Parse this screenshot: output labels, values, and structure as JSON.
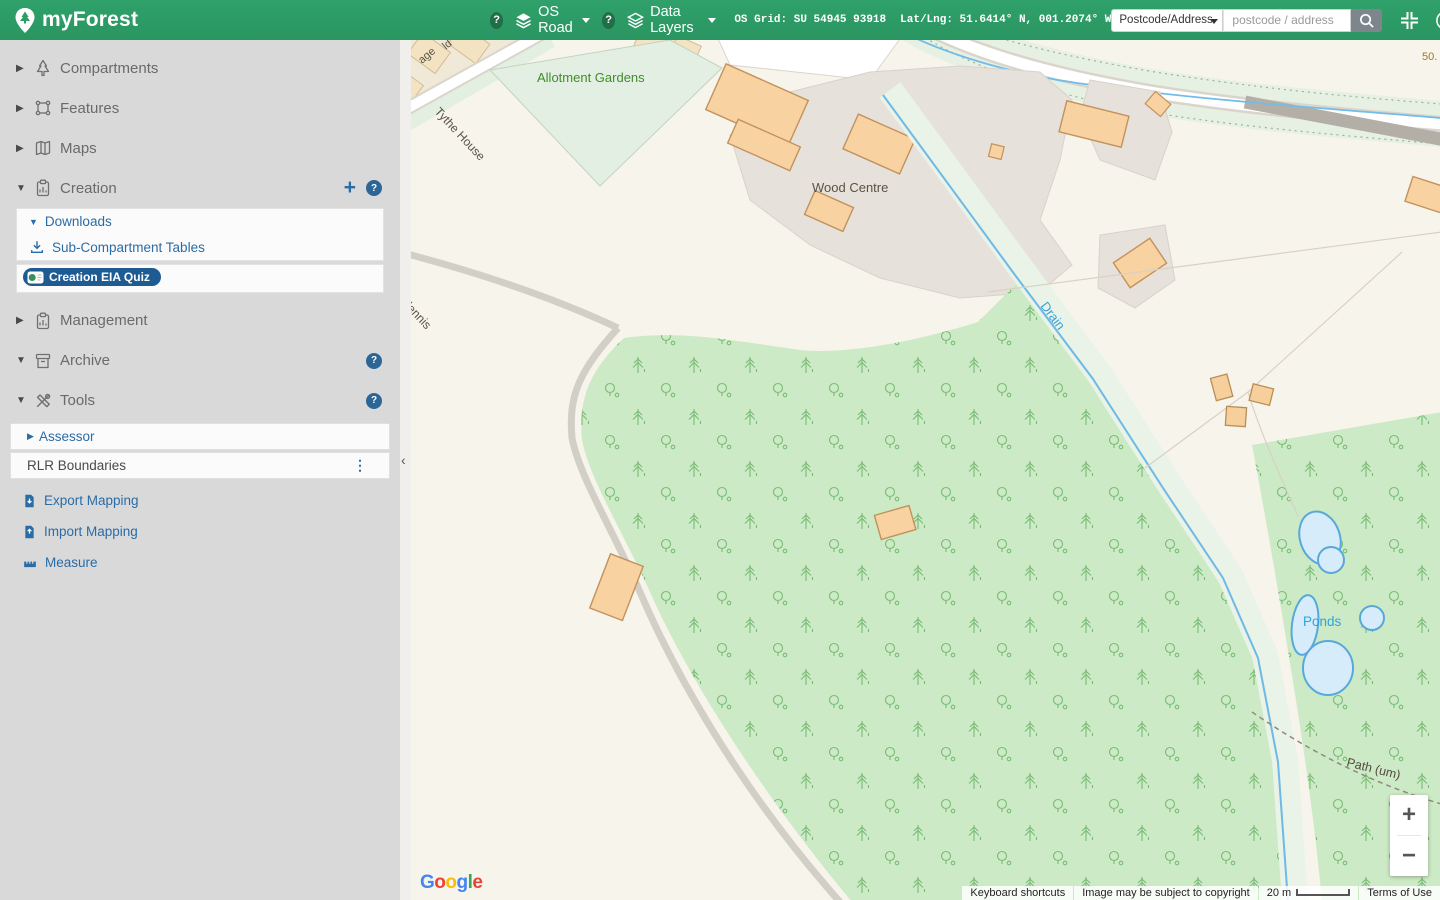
{
  "header": {
    "brand": "myForest",
    "help_glyph": "?",
    "basemap_selector": "OS Road",
    "layers_selector": "Data Layers",
    "os_grid": "OS Grid: SU 54945 93918",
    "latlng": "Lat/Lng: 51.6414° N, 001.2074° W",
    "search_type": "Postcode/Address",
    "search_placeholder": "postcode / address"
  },
  "sidebar": {
    "compartments": "Compartments",
    "features": "Features",
    "maps": "Maps",
    "creation": "Creation",
    "downloads": "Downloads",
    "subcompartment_tables": "Sub-Compartment Tables",
    "creation_eia_quiz": "Creation EIA Quiz",
    "management": "Management",
    "archive": "Archive",
    "tools": "Tools",
    "assessor": "Assessor",
    "rlr_boundaries": "RLR Boundaries",
    "export_mapping": "Export Mapping",
    "import_mapping": "Import Mapping",
    "measure": "Measure",
    "glyphs": {
      "caret_right": "▶",
      "caret_down": "▼",
      "plus": "+",
      "question": "?",
      "kebab": "⋮"
    }
  },
  "map": {
    "labels": {
      "allotment_gardens": "Allotment Gardens",
      "wood_centre": "Wood Centre",
      "tythe_house": "Tythe House",
      "house_partial": "dennis",
      "street_partial_1": "ld",
      "street_partial_2": "age",
      "drain": "Drain",
      "ponds": "Ponds",
      "path_um": "Path (um)",
      "contour_partial": "50."
    },
    "controls": {
      "zoom_in": "+",
      "zoom_out": "−",
      "collapse": "‹"
    },
    "attribution": {
      "keyboard_shortcuts": "Keyboard shortcuts",
      "copyright_notice": "Image may be subject to copyright",
      "scale_label": "20 m",
      "terms_of_use": "Terms of Use"
    },
    "google": {
      "letters": [
        "G",
        "o",
        "o",
        "g",
        "l",
        "e"
      ]
    }
  },
  "colors": {
    "brand_green": "#2e9c67",
    "link_blue": "#2a6ca6",
    "pill_navy": "#1e5b92",
    "woodland_green": "#cdeac6",
    "building_orange": "#f8d2a0",
    "water_blue": "#d7ecfa",
    "map_cream": "#f7f4ec"
  }
}
